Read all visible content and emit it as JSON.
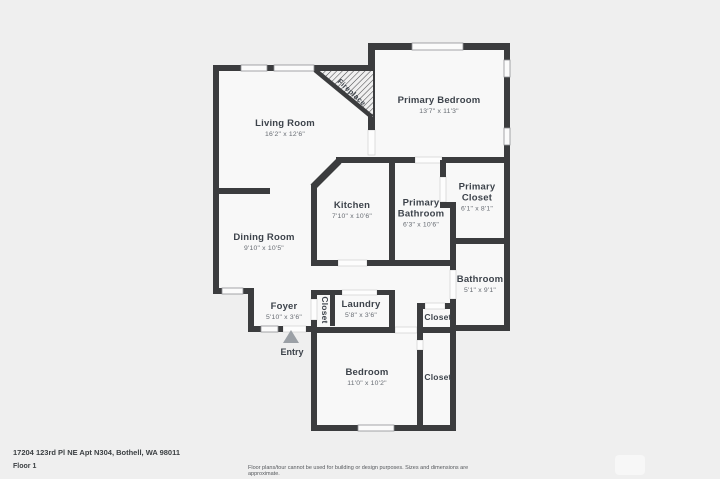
{
  "meta": {
    "address": "17204 123rd Pl NE Apt N304, Bothell, WA 98011",
    "floor_label": "Floor 1",
    "disclaimer": "Floor plans/tour cannot be used for building or design purposes. Sizes and dimensions are approximate."
  },
  "colors": {
    "background": "#efefef",
    "room_fill": "#f8f8f8",
    "wall": "#3b3c3e",
    "window_fill": "#fbfbfb",
    "opening_line": "#cfcfcf",
    "label_text": "#3d434b",
    "dims_text": "#666b72",
    "entry_arrow": "#9ba0a6"
  },
  "labels": {
    "living_room": {
      "name": "Living Room",
      "dims": "16'2\" x 12'6\""
    },
    "primary_bedroom": {
      "name": "Primary Bedroom",
      "dims": "13'7\" x 11'3\""
    },
    "kitchen": {
      "name": "Kitchen",
      "dims": "7'10\" x 10'6\""
    },
    "primary_bathroom": {
      "name": "Primary Bathroom",
      "dims": "6'3\" x 10'6\""
    },
    "primary_closet": {
      "name": "Primary Closet",
      "dims": "6'1\" x 8'1\""
    },
    "dining_room": {
      "name": "Dining Room",
      "dims": "9'10\" x 10'5\""
    },
    "bathroom": {
      "name": "Bathroom",
      "dims": "5'1\" x 9'1\""
    },
    "foyer": {
      "name": "Foyer",
      "dims": "5'10\" x 3'6\""
    },
    "laundry": {
      "name": "Laundry",
      "dims": "5'8\" x 3'6\""
    },
    "bedroom": {
      "name": "Bedroom",
      "dims": "11'0\" x 10'2\""
    },
    "closet_hall": {
      "name": "Closet"
    },
    "closet_center": {
      "name": "Closet"
    },
    "closet_bedroom": {
      "name": "Closet"
    },
    "fireplace": {
      "name": "Fireplace"
    },
    "entry": {
      "name": "Entry"
    }
  }
}
